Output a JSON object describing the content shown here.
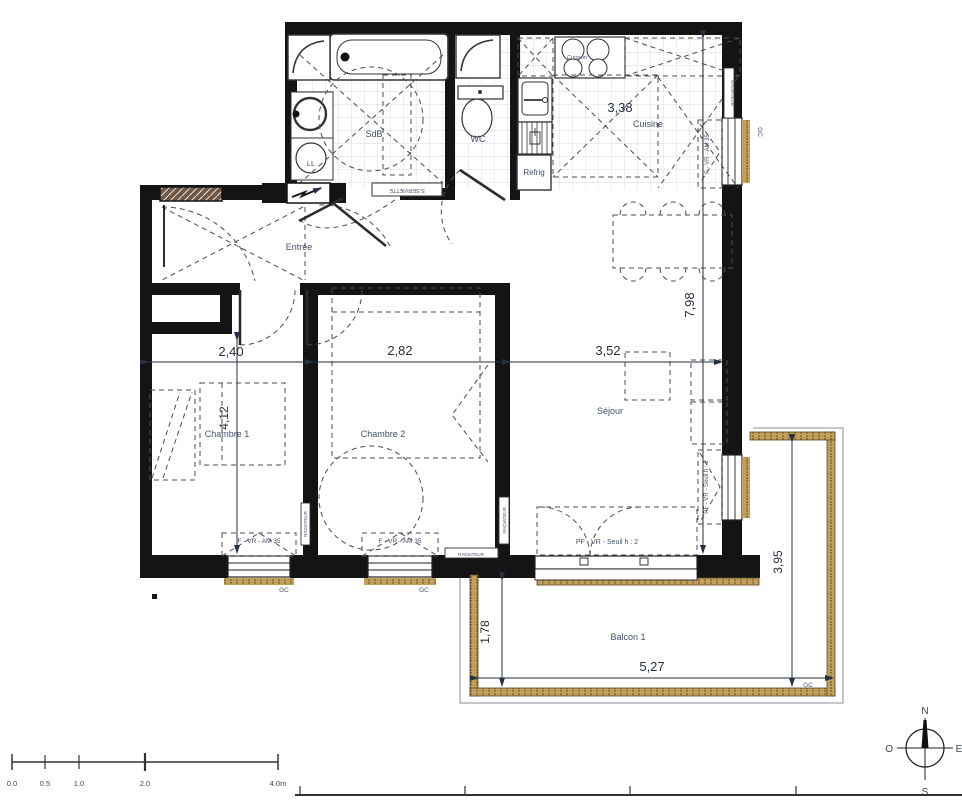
{
  "plan": {
    "rooms": {
      "sdb": "SdB",
      "wc": "WC",
      "cuisine": "Cuisine",
      "entree": "Entrée",
      "chambre1": "Chambre 1",
      "chambre2": "Chambre 2",
      "sejour": "Séjour",
      "balcon": "Balcon 1"
    },
    "equipment": {
      "lave_linge": "LL",
      "refrigerateur": "Refrig",
      "cuisson": "Cuisson",
      "seche_serviette": "S.SERVIETTE",
      "radiateur": "RADIATEUR"
    },
    "dimensions": {
      "cuisine_largeur": "3,38",
      "hauteur_droite": "7,98",
      "chambre1_largeur": "2,40",
      "chambre2_largeur": "2,82",
      "sejour_largeur": "3,52",
      "chambre1_hauteur": "4,12",
      "balcon_profondeur": "1,78",
      "balcon_largeur": "5,27",
      "balcon_hauteur_droite": "3,95"
    },
    "openings": {
      "fenetre": "F - VR - AM 35",
      "porte_fenetre": "PF - VR - Seuil h : 2",
      "gc": "GC"
    },
    "compass": {
      "north": "N",
      "south": "S",
      "east": "E",
      "west": "O"
    },
    "scale_bar": {
      "labels": [
        "0.0",
        "0.5",
        "1.0",
        "2.0",
        "4.0m"
      ]
    }
  }
}
